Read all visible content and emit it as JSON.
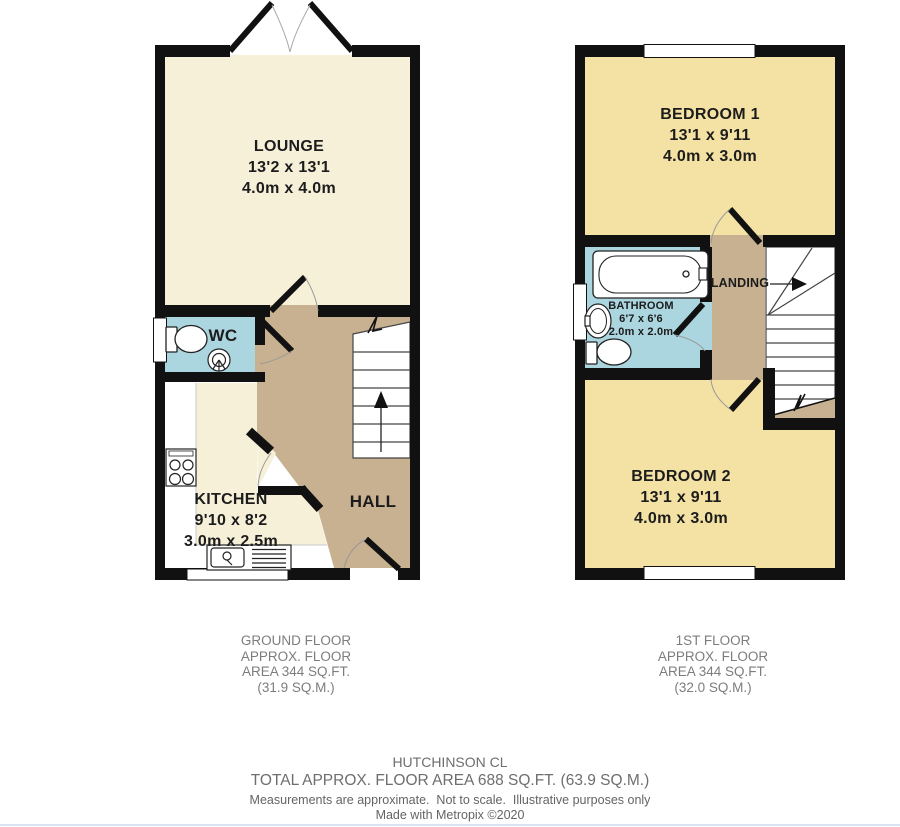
{
  "colors": {
    "floor_cream": "#F6F0D9",
    "floor_tan": "#C7B190",
    "floor_blue": "#ABD5DF",
    "floor_yellow": "#F4E2A4",
    "wall": "#111111",
    "stair_line": "#444444",
    "room_text": "#1C1C1C",
    "caption_text": "#7D7D7D",
    "footer_text": "#6E6E6E",
    "footer_text2": "#646464",
    "bottom_rule": "#D7E3F0"
  },
  "ground_floor": {
    "rooms": {
      "lounge": {
        "name": "LOUNGE",
        "imperial": "13'2 x 13'1",
        "metric": "4.0m x 4.0m"
      },
      "wc": {
        "name": "WC"
      },
      "kitchen": {
        "name": "KITCHEN",
        "imperial": "9'10 x 8'2",
        "metric": "3.0m x 2.5m"
      },
      "hall": {
        "name": "HALL"
      }
    },
    "caption": {
      "line1": "GROUND FLOOR",
      "line2": "APPROX. FLOOR",
      "line3": "AREA 344 SQ.FT.",
      "line4": "(31.9 SQ.M.)"
    }
  },
  "first_floor": {
    "rooms": {
      "bedroom1": {
        "name": "BEDROOM 1",
        "imperial": "13'1 x 9'11",
        "metric": "4.0m x 3.0m"
      },
      "bathroom": {
        "name": "BATHROOM",
        "imperial": "6'7 x 6'6",
        "metric": "2.0m x 2.0m"
      },
      "landing": {
        "name": "LANDING"
      },
      "bedroom2": {
        "name": "BEDROOM 2",
        "imperial": "13'1 x 9'11",
        "metric": "4.0m x 3.0m"
      }
    },
    "caption": {
      "line1": "1ST FLOOR",
      "line2": "APPROX. FLOOR",
      "line3": "AREA 344 SQ.FT.",
      "line4": "(32.0 SQ.M.)"
    }
  },
  "footer": {
    "address": "HUTCHINSON CL",
    "total_area": "TOTAL APPROX. FLOOR AREA 688 SQ.FT. (63.9 SQ.M.)",
    "disclaimer": "Measurements are approximate.  Not to scale.  Illustrative purposes only",
    "credit": "Made with Metropix ©2020"
  }
}
